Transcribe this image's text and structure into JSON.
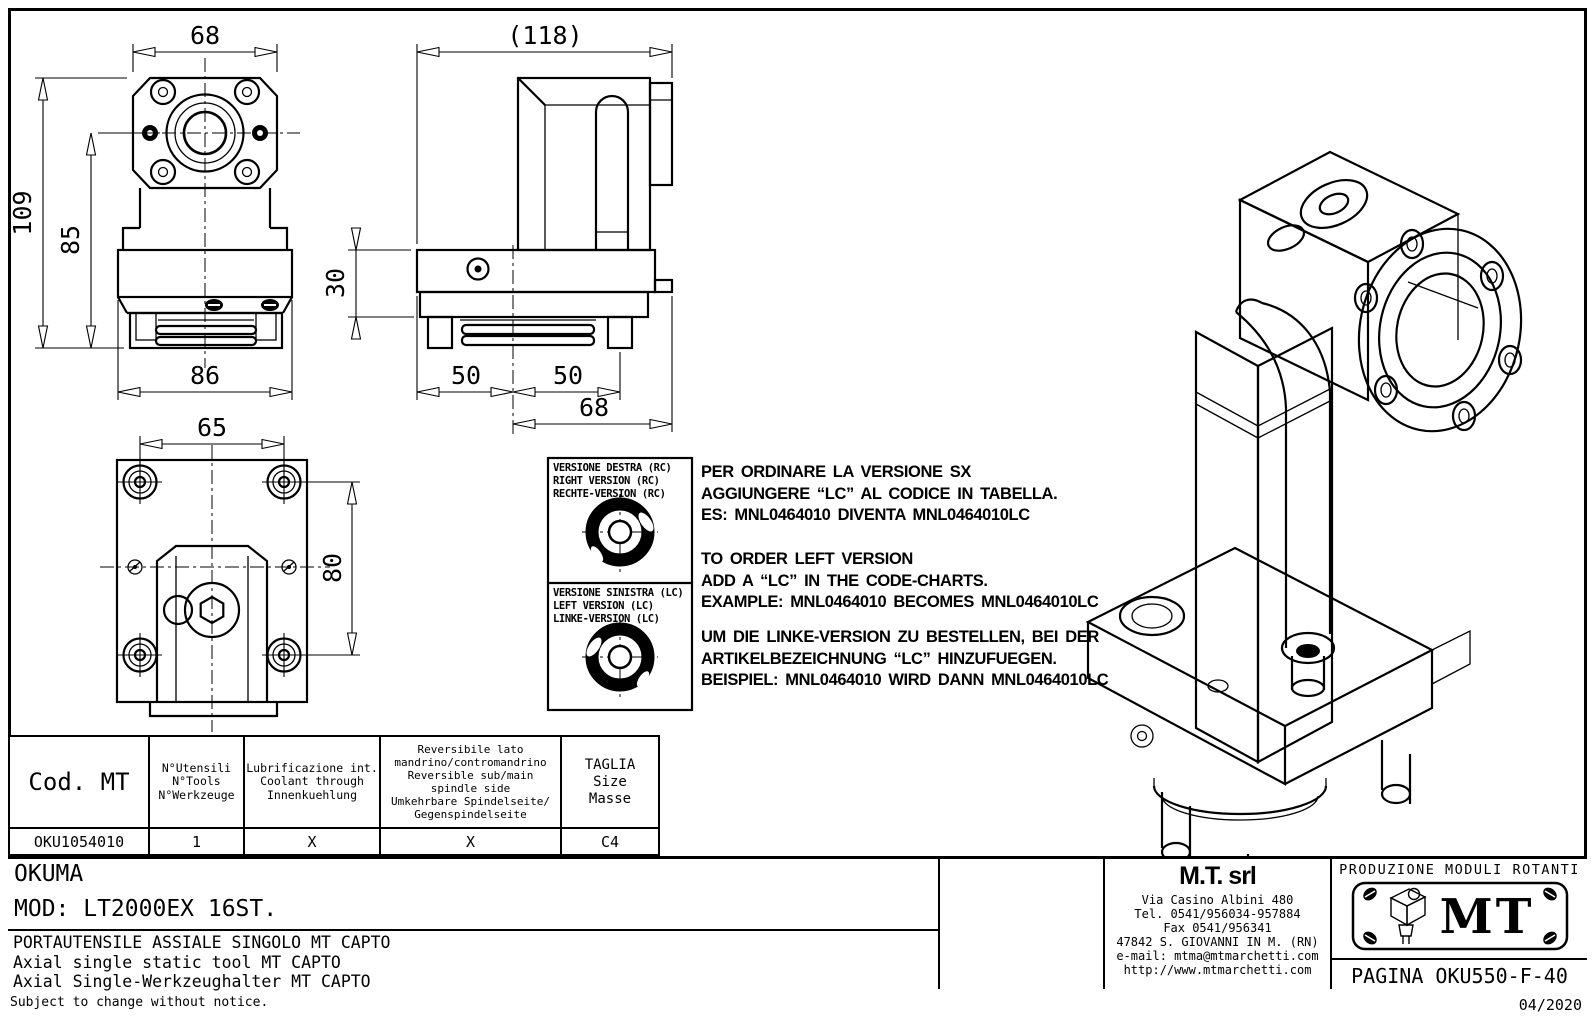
{
  "colors": {
    "ink": "#000000",
    "paper": "#ffffff"
  },
  "dims": {
    "front_width_top": "68",
    "front_height_total": "109",
    "front_height_axis": "85",
    "front_width_body": "86",
    "side_overall": "(118)",
    "side_plate_height": "30",
    "side_left": "50",
    "side_right": "50",
    "side_offset": "68",
    "top_spacing_x": "65",
    "top_spacing_y": "80"
  },
  "versions": {
    "right": [
      "VERSIONE DESTRA (RC)",
      "RIGHT VERSION (RC)",
      "RECHTE-VERSION (RC)"
    ],
    "left": [
      "VERSIONE SINISTRA (LC)",
      "LEFT VERSION (LC)",
      "LINKE-VERSION (LC)"
    ]
  },
  "ordering_notes": {
    "italian": "PER ORDINARE LA VERSIONE SX\nAGGIUNGERE “LC” AL CODICE IN TABELLA.\nES: MNL0464010 DIVENTA MNL0464010LC",
    "english": "TO ORDER LEFT VERSION\nADD A “LC” IN THE CODE-CHARTS.\nEXAMPLE: MNL0464010 BECOMES MNL0464010LC",
    "german": "UM DIE LINKE-VERSION ZU BESTELLEN, BEI DER\nARTIKELBEZEICHNUNG “LC” HINZUFUEGEN.\nBEISPIEL: MNL0464010 WIRD DANN MNL0464010LC"
  },
  "table": {
    "col_code": "Cod. MT",
    "col_tools": "N°Utensili\nN°Tools\nN°Werkzeuge",
    "col_coolant": "Lubrificazione int.\nCoolant through\nInnenkuehlung",
    "col_reversible": "Reversibile lato\nmandrino/contromandrino\nReversible sub/main\nspindle side\nUmkehrbare Spindelseite/\nGegenspindelseite",
    "col_size": "TAGLIA\nSize\nMasse",
    "row": {
      "code": "OKU1054010",
      "tools": "1",
      "coolant": "X",
      "reversible": "X",
      "size": "C4"
    }
  },
  "title_block": {
    "customer": "OKUMA",
    "model": "MOD: LT2000EX 16ST.",
    "description_it": "PORTAUTENSILE ASSIALE SINGOLO MT CAPTO",
    "description_en": "Axial single static tool MT CAPTO",
    "description_de": "Axial Single-Werkzeughalter MT CAPTO"
  },
  "supplier": {
    "name": "M.T. srl",
    "address": "Via Casino Albini 480",
    "phone": "Tel. 0541/956034-957884",
    "fax": "Fax 0541/956341",
    "city": "47842 S. GIOVANNI IN M. (RN)",
    "email": "e-mail: mtma@mtmarchetti.com",
    "website": "http://www.mtmarchetti.com"
  },
  "logo_block": {
    "tagline": "PRODUZIONE MODULI ROTANTI",
    "logo_text": "MT",
    "page_ref": "PAGINA OKU550-F-40"
  },
  "footer": {
    "left": "Subject to change without notice.",
    "right": "04/2020"
  }
}
